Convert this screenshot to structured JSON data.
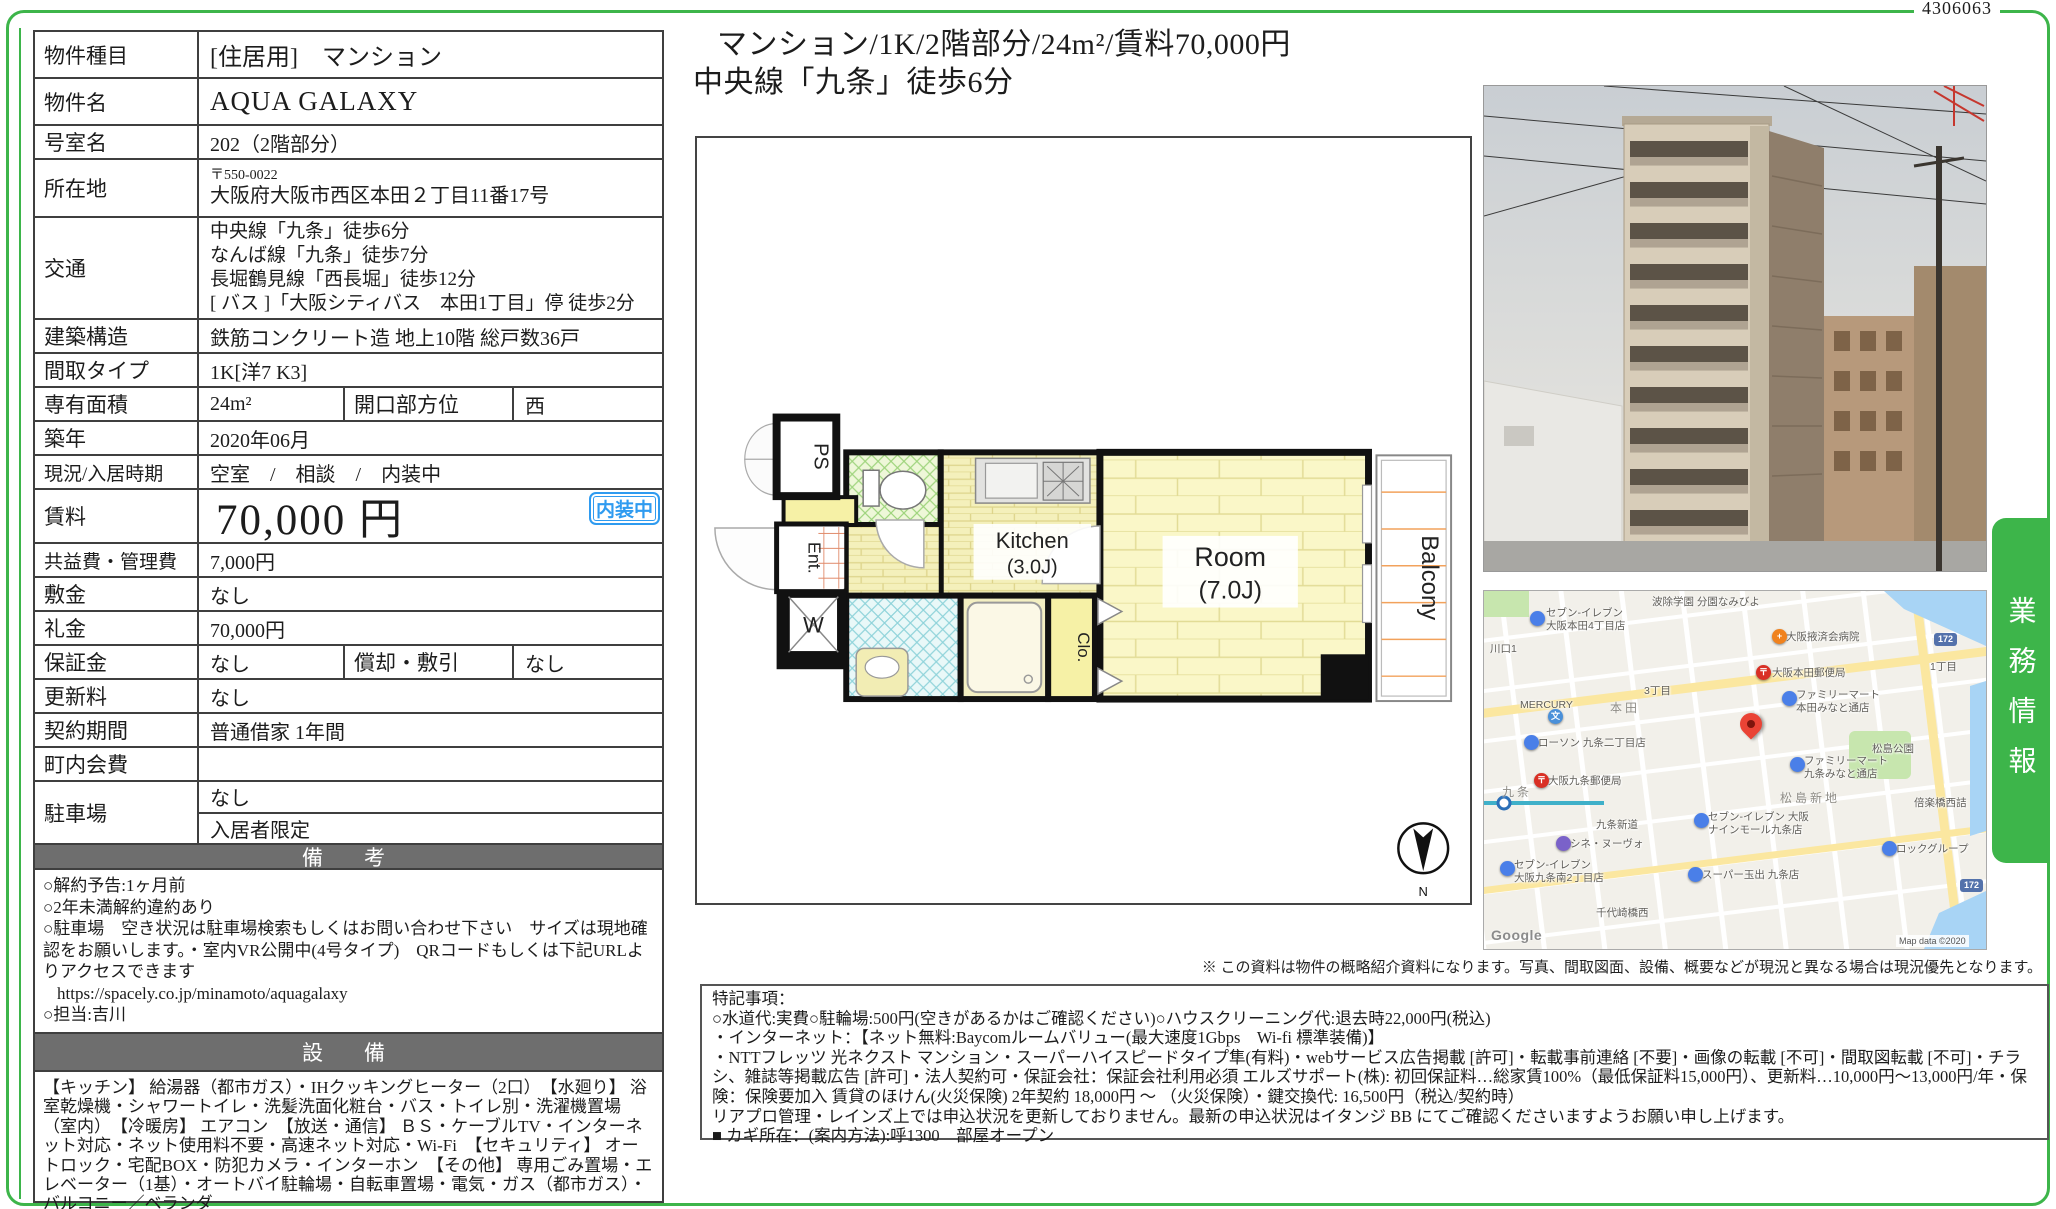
{
  "doc_number": "4306063",
  "headline": {
    "line1": "マンション/1K/2階部分/24m²/賃料70,000円",
    "line2": "中央線「九条」徒歩6分"
  },
  "table": {
    "rows": {
      "property_type": {
        "label": "物件種目",
        "value": "[住居用]　マンション"
      },
      "property_name": {
        "label": "物件名",
        "value": "AQUA GALAXY"
      },
      "room_no": {
        "label": "号室名",
        "value": "202（2階部分）"
      },
      "address": {
        "label": "所在地",
        "postal": "〒550-0022",
        "value": "大阪府大阪市西区本田２丁目11番17号"
      },
      "access": {
        "label": "交通",
        "lines": [
          "中央線「九条」徒歩6分",
          "なんば線「九条」徒歩7分",
          "長堀鶴見線「西長堀」徒歩12分",
          "[ バス ]「大阪シティバス　本田1丁目」停 徒歩2分"
        ]
      },
      "structure": {
        "label": "建築構造",
        "value": "鉄筋コンクリート造 地上10階 総戸数36戸"
      },
      "layout_type": {
        "label": "間取タイプ",
        "value": "1K[洋7 K3]"
      },
      "area": {
        "label": "専有面積",
        "value": "24m²",
        "label2": "開口部方位",
        "value2": "西"
      },
      "built": {
        "label": "築年",
        "value": "2020年06月"
      },
      "status": {
        "label": "現況/入居時期",
        "value": "空室　/　相談　/　内装中"
      },
      "rent": {
        "label": "賃料",
        "value": "70,000 円",
        "badge": "内装中"
      },
      "mgmt_fee": {
        "label": "共益費・管理費",
        "value": "7,000円"
      },
      "deposit": {
        "label": "敷金",
        "value": "なし"
      },
      "key_money": {
        "label": "礼金",
        "value": "70,000円"
      },
      "guarantee": {
        "label": "保証金",
        "value": "なし",
        "label2": "償却・敷引",
        "value2": "なし"
      },
      "renewal_fee": {
        "label": "更新料",
        "value": "なし"
      },
      "term": {
        "label": "契約期間",
        "value": "普通借家 1年間"
      },
      "town_fee": {
        "label": "町内会費",
        "value": ""
      },
      "parking": {
        "label": "駐車場",
        "value1": "なし",
        "value2": "入居者限定"
      }
    }
  },
  "remarks": {
    "header": "備　考",
    "lines": [
      "○解約予告:1ヶ月前",
      "○2年未満解約違約あり",
      "○駐車場　空き状況は駐車場検索もしくはお問い合わせ下さい　サイズは現地確認をお願いします。・室内VR公開中(4号タイプ)　QRコードもしくは下記URLよりアクセスできます",
      {
        "text": "https://spacely.co.jp/minamoto/aquagalaxy",
        "cls": "url-line",
        "inter": true
      },
      "○担当:吉川"
    ]
  },
  "equipment": {
    "header": "設　備",
    "text": "【キッチン】 給湯器（都市ガス）・IHクッキングヒーター（2口）　【水廻り】 浴室乾燥機・シャワートイレ・洗髪洗面化粧台・バス・トイレ別・洗濯機置場（室内）　【冷暖房】 エアコン　【放送・通信】 ＢＳ・ケーブルTV・インターネット対応・ネット使用料不要・高速ネット対応・Wi-Fi　【セキュリティ】 オートロック・宅配BOX・防犯カメラ・インターホン　【その他】 専用ごみ置場・エレベーター（1基）・オートバイ駐輪場・自転車置場・電気・ガス（都市ガス）・バルコニー／ベランダ"
  },
  "floorplan": {
    "ps": "PS",
    "ent": "Ent.",
    "w": "W",
    "kitchen_name": "Kitchen",
    "kitchen_size": "(3.0J)",
    "room_name": "Room",
    "room_size": "(7.0J)",
    "balcony": "Balcony",
    "closet": "Clo.",
    "compass_n": "N"
  },
  "disclaimer": "※ この資料は物件の概略紹介資料になります。写真、間取図面、設備、概要などが現況と異なる場合は現況優先となります。",
  "side_tab": {
    "label": "業務情報"
  },
  "notes": {
    "lines": [
      "特記事項：",
      "○水道代:実費○駐輪場:500円(空きがあるかはご確認ください)○ハウスクリーニング代:退去時22,000円(税込)",
      "・インターネット：【ネット無料:Baycomルームバリュー(最大速度1Gbps　Wi-fi 標準装備)】",
      "・NTTフレッツ 光ネクスト マンション・スーパーハイスピードタイプ隼(有料)・webサービス広告掲載 [許可]・転載事前連絡 [不要]・画像の転載 [不可]・間取図転載 [不可]・チラシ、雑誌等掲載広告 [許可]・法人契約可・保証会社：保証会社利用必須 エルズサポート(株): 初回保証料…総家賃100%（最低保証料15,000円）、更新料…10,000円〜13,000円/年・保険：保険要加入 賃貸のほけん(火災保険) 2年契約 18,000円 〜 （火災保険）・鍵交換代: 16,500円（税込/契約時）",
      "リアプロ管理・レインズ上では申込状況を更新しておりません。最新の申込状況はイタンジ BB にてご確認くださいますようお願い申し上げます。",
      "■ カギ所在：(案内方法):呼1300　部屋オープン"
    ]
  },
  "map": {
    "items": [
      {
        "text": "セブン-イレブン\n大阪本田4丁目店",
        "x": 62,
        "y": 16,
        "cls": "m-lbl"
      },
      {
        "text": "波除学園 分園なみびよ",
        "x": 168,
        "y": 5,
        "cls": "m-lbl"
      },
      {
        "text": "川口1",
        "x": 6,
        "y": 52,
        "cls": "m-lbl"
      },
      {
        "text": "大阪掖済会病院",
        "x": 302,
        "y": 40,
        "cls": "m-lbl"
      },
      {
        "text": "大阪本田郵便局",
        "x": 288,
        "y": 76,
        "cls": "m-lbl"
      },
      {
        "text": "1丁目",
        "x": 446,
        "y": 70,
        "cls": "m-lbl"
      },
      {
        "text": "3丁目",
        "x": 160,
        "y": 94,
        "cls": "m-lbl"
      },
      {
        "text": "MERCURY",
        "x": 36,
        "y": 108,
        "cls": "m-lbl"
      },
      {
        "text": "本田",
        "x": 126,
        "y": 110,
        "cls": "m-area"
      },
      {
        "text": "ファミリーマート\n本田みなと通店",
        "x": 312,
        "y": 98,
        "cls": "m-lbl"
      },
      {
        "text": "ローソン 九条二丁目店",
        "x": 54,
        "y": 146,
        "cls": "m-lbl"
      },
      {
        "text": "松島公園",
        "x": 388,
        "y": 152,
        "cls": "m-lbl"
      },
      {
        "text": "大阪九条郵便局",
        "x": 64,
        "y": 184,
        "cls": "m-lbl"
      },
      {
        "text": "ファミリーマート\n九条みなと通店",
        "x": 320,
        "y": 164,
        "cls": "m-lbl"
      },
      {
        "text": "松島新地",
        "x": 296,
        "y": 200,
        "cls": "m-area"
      },
      {
        "text": "九条",
        "x": 18,
        "y": 194,
        "cls": "m-area"
      },
      {
        "text": "倍楽橋西詰",
        "x": 430,
        "y": 206,
        "cls": "m-lbl"
      },
      {
        "text": "九条新道",
        "x": 112,
        "y": 228,
        "cls": "m-lbl"
      },
      {
        "text": "セブン-イレブン 大阪\nナインモール九条店",
        "x": 224,
        "y": 220,
        "cls": "m-lbl"
      },
      {
        "text": "シネ・ヌーヴォ",
        "x": 86,
        "y": 247,
        "cls": "m-lbl"
      },
      {
        "text": "セブン-イレブン\n大阪九条南2丁目店",
        "x": 30,
        "y": 268,
        "cls": "m-lbl"
      },
      {
        "text": "ロックグループ",
        "x": 412,
        "y": 252,
        "cls": "m-lbl"
      },
      {
        "text": "スーパー玉出 九条店",
        "x": 218,
        "y": 278,
        "cls": "m-lbl"
      },
      {
        "text": "千代崎橋西",
        "x": 112,
        "y": 316,
        "cls": "m-lbl"
      },
      {
        "text": "172",
        "x": 450,
        "y": 42,
        "cls": "m-badge"
      },
      {
        "text": "172",
        "x": 476,
        "y": 288,
        "cls": "m-badge"
      },
      {
        "text": "Google",
        "x": 7,
        "y": 336,
        "cls": "m-google",
        "inter": true
      },
      {
        "text": "Map data ©2020",
        "x": 412,
        "y": 344,
        "cls": "m-copy"
      },
      {
        "text": "",
        "x": 46,
        "y": 20,
        "cls": "m-pin",
        "color": "#4a7fe8",
        "inter": true
      },
      {
        "text": "+",
        "x": 288,
        "y": 38,
        "cls": "m-pin",
        "color": "#f0821e",
        "inter": true
      },
      {
        "text": "〒",
        "x": 272,
        "y": 74,
        "cls": "m-pin",
        "color": "#d93025",
        "inter": true
      },
      {
        "text": "",
        "x": 298,
        "y": 100,
        "cls": "m-pin",
        "color": "#4a7fe8",
        "inter": true
      },
      {
        "text": "",
        "x": 40,
        "y": 144,
        "cls": "m-pin",
        "color": "#4a7fe8",
        "inter": true
      },
      {
        "text": "文",
        "x": 64,
        "y": 118,
        "cls": "m-pin",
        "color": "#4a90d9",
        "inter": true
      },
      {
        "text": "〒",
        "x": 50,
        "y": 182,
        "cls": "m-pin",
        "color": "#d93025",
        "inter": true
      },
      {
        "text": "",
        "x": 306,
        "y": 166,
        "cls": "m-pin",
        "color": "#4a7fe8",
        "inter": true
      },
      {
        "text": "",
        "x": 210,
        "y": 222,
        "cls": "m-pin",
        "color": "#4a7fe8",
        "inter": true
      },
      {
        "text": "",
        "x": 72,
        "y": 245,
        "cls": "m-pin",
        "color": "#7a62c9",
        "inter": true
      },
      {
        "text": "",
        "x": 16,
        "y": 270,
        "cls": "m-pin",
        "color": "#4a7fe8",
        "inter": true
      },
      {
        "text": "",
        "x": 398,
        "y": 250,
        "cls": "m-pin",
        "color": "#4a7fe8",
        "inter": true
      },
      {
        "text": "",
        "x": 204,
        "y": 276,
        "cls": "m-pin",
        "color": "#4a7fe8",
        "inter": true
      },
      {
        "text": "",
        "x": 256,
        "y": 122,
        "cls": "m-redpin",
        "inter": true
      }
    ]
  },
  "icons": {
    "compass": "north-compass-icon",
    "red_pin": "destination-pin-icon",
    "post_pin": "post-office-pin-icon",
    "hospital_pin": "hospital-pin-icon",
    "school_pin": "school-pin-icon",
    "store_pin": "store-pin-icon"
  },
  "colors": {
    "frame_green": "#3db54a",
    "badge_blue": "#2f9bf0",
    "header_gray": "#6e6e6e",
    "pin_red": "#ea4335"
  }
}
